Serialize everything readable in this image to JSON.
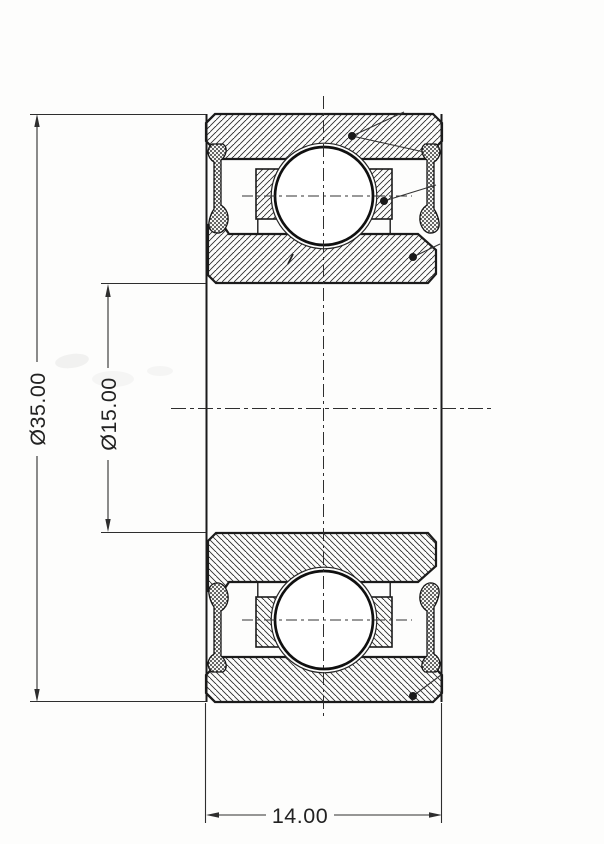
{
  "drawing": {
    "dimensions": {
      "outer_diameter": "Ø35.00",
      "bore_diameter": "Ø15.00",
      "width": "14.00"
    },
    "colors": {
      "ink": "#1f1f1f",
      "thin_line": "#2e2e2e",
      "paper": "#fdfdfc"
    }
  }
}
